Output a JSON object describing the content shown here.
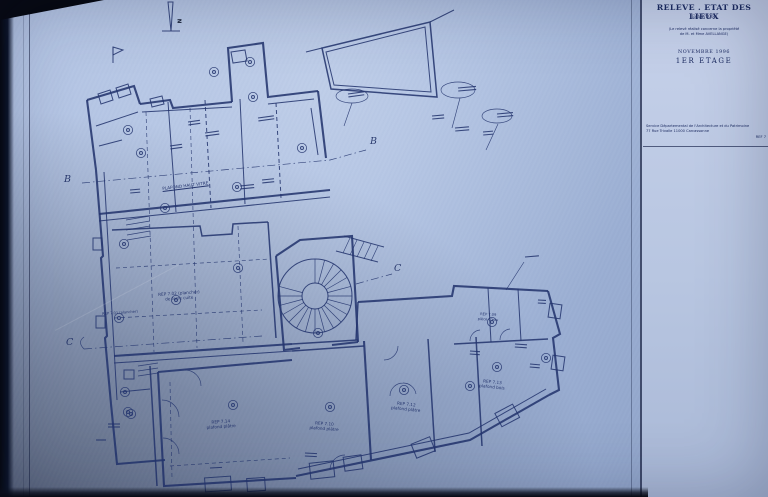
{
  "title_block": {
    "title": "RELEVE . ETAT DES LIEUX",
    "scale": "Ech.1/100e",
    "note_line1": "(Le relevé réalisé concerne la propriété",
    "note_line2": "de M. et Mme AVELLANGE)",
    "date": "NOVEMBRE 1996",
    "floor": "1ER ETAGE",
    "service_line1": "Service Départemental de l'Architecture et du Patrimoine",
    "service_line2": "77 Rue Trivalle 11000 Carcassonne",
    "ref": "REF 7"
  },
  "compass": {
    "north_label": "N"
  },
  "section_markers": {
    "b_left": "B",
    "b_right": "B",
    "c_left": "C",
    "c_right": "C"
  },
  "plan_labels": {
    "plafond_vitre": "PLAFOND HAUT VITRE",
    "room_702_l1": "REP 7.02 (plancher)",
    "room_702_l2": "de terre cuite",
    "room_701": "REP 7.01 (plancher)",
    "room_714_l1": "REP 7.14",
    "room_714_l2": "plafond plâtre",
    "room_710_l1": "REP 7.10",
    "room_710_l2": "plafond plâtre",
    "room_712_l1": "REP 7.12",
    "room_712_l2": "plafond plâtre",
    "room_713_l1": "REP 7.13",
    "room_713_l2": "plafond bois",
    "room_709_l1": "REP 7.09",
    "room_709_l2": "pièce d'eau"
  },
  "colors": {
    "paper": "#a9bcdf",
    "panel": "#bdc9e2",
    "ink": "#24356e"
  }
}
